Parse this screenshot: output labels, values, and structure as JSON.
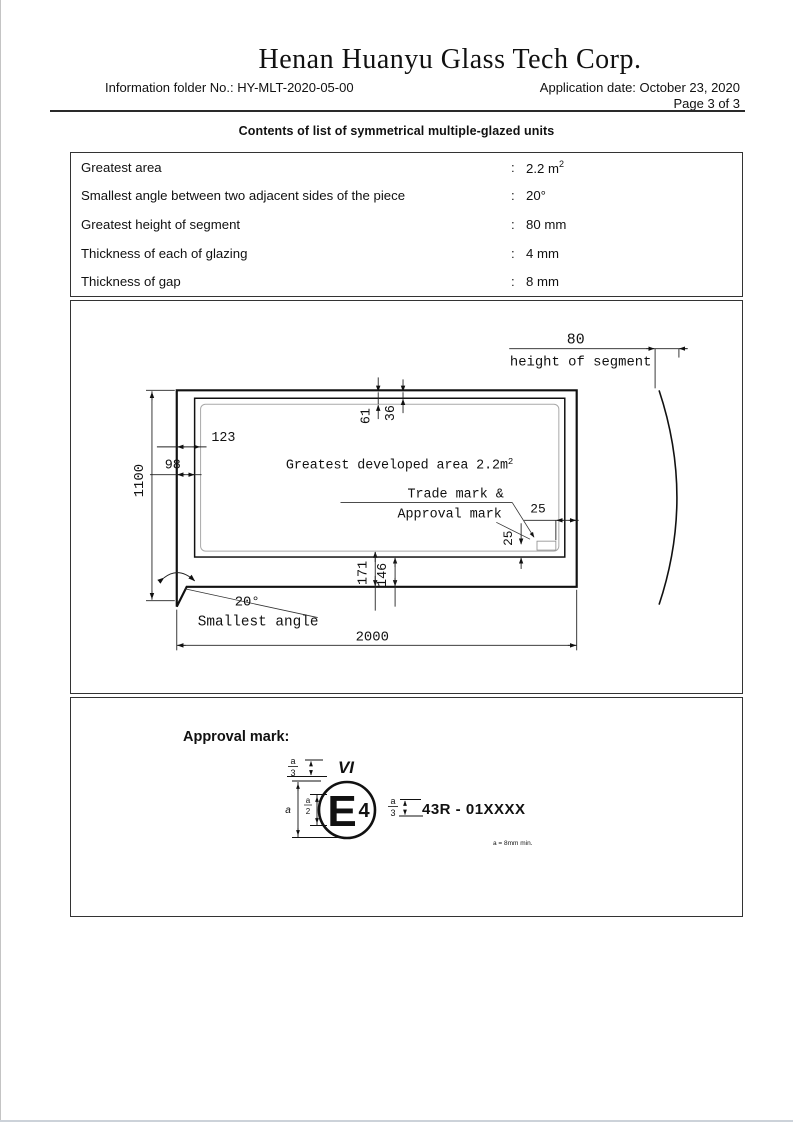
{
  "header": {
    "company": "Henan Huanyu Glass Tech Corp.",
    "info_folder": "Information folder No.: HY-MLT-2020-05-00",
    "application_date": "Application date: October 23, 2020",
    "page_indicator": "Page 3 of 3",
    "doc_title": "Contents of list of symmetrical multiple-glazed units"
  },
  "spec_table": {
    "colon": ":",
    "rows": [
      {
        "label": "Greatest area",
        "value": "2.2 m",
        "sup": "2"
      },
      {
        "label": "Smallest angle between two adjacent sides of the piece",
        "value": "20°"
      },
      {
        "label": "Greatest height of segment",
        "value": "80 mm"
      },
      {
        "label": "Thickness of each of glazing",
        "value": "4 mm"
      },
      {
        "label": "Thickness of gap",
        "value": "8 mm"
      }
    ]
  },
  "drawing": {
    "dim_segment_value": "80",
    "dim_segment_label": "height of segment",
    "dim_top_outer": "61",
    "dim_top_inner": "36",
    "dim_left_outer": "123",
    "dim_left_inner": "98",
    "dim_height": "1100",
    "dim_bottom_outer": "171",
    "dim_bottom_inner": "146",
    "dim_width": "2000",
    "dim_mark_h": "25",
    "dim_mark_v": "25",
    "area_label": "Greatest developed area 2.2m",
    "area_sup": "2",
    "mark_note_line1": "Trade mark &",
    "mark_note_line2": "Approval mark",
    "angle_value": "20°",
    "angle_label": "Smallest angle"
  },
  "approval": {
    "heading": "Approval mark:",
    "vi_label": "VI",
    "circle_letter": "E",
    "circle_number": "4",
    "code": "43R - 01XXXX",
    "frac_a": "a",
    "frac_2": "2",
    "frac_3": "3",
    "dim_a_label": "a",
    "note": "a = 8mm min."
  }
}
